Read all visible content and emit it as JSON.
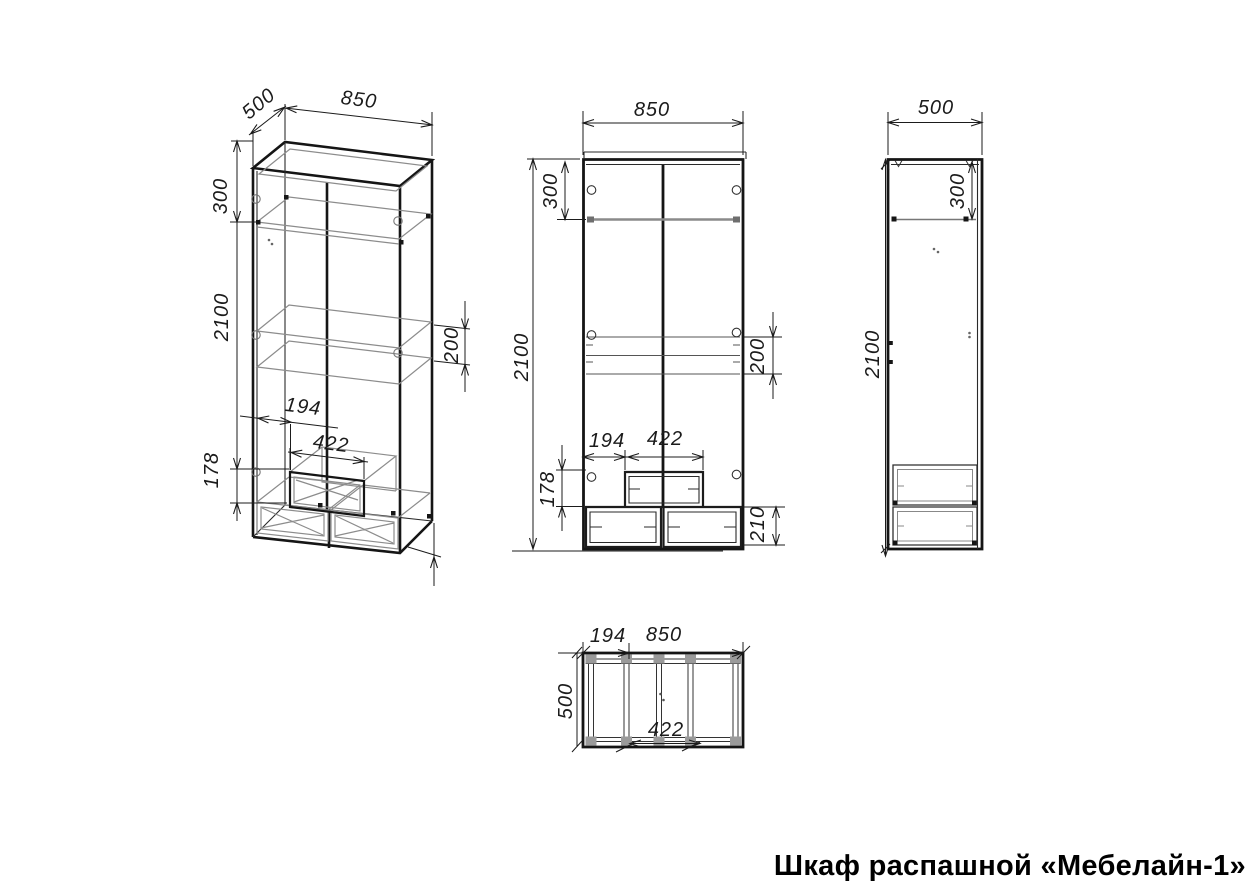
{
  "drawing": {
    "title": "Шкаф распашной «Мебелайн-1»",
    "colors": {
      "line": "#1c1c1c",
      "wireframe": "#8c8c8c",
      "background": "#ffffff"
    },
    "dims": {
      "iso": {
        "width": "850",
        "depth": "500",
        "top_section": "300",
        "height": "2100",
        "shelf_gap": "200",
        "drawer_offset": "194",
        "drawer_width": "422",
        "drawer_height": "178"
      },
      "front": {
        "width": "850",
        "top_section": "300",
        "height": "2100",
        "shelf_gap": "200",
        "drawer_offset": "194",
        "drawer_width": "422",
        "drawer_height": "178",
        "bottom_drawer_height": "210"
      },
      "side": {
        "depth": "500",
        "top_section": "300",
        "height": "2100"
      },
      "plan": {
        "offset": "194",
        "width": "850",
        "depth": "500",
        "drawer_width": "422"
      }
    }
  }
}
